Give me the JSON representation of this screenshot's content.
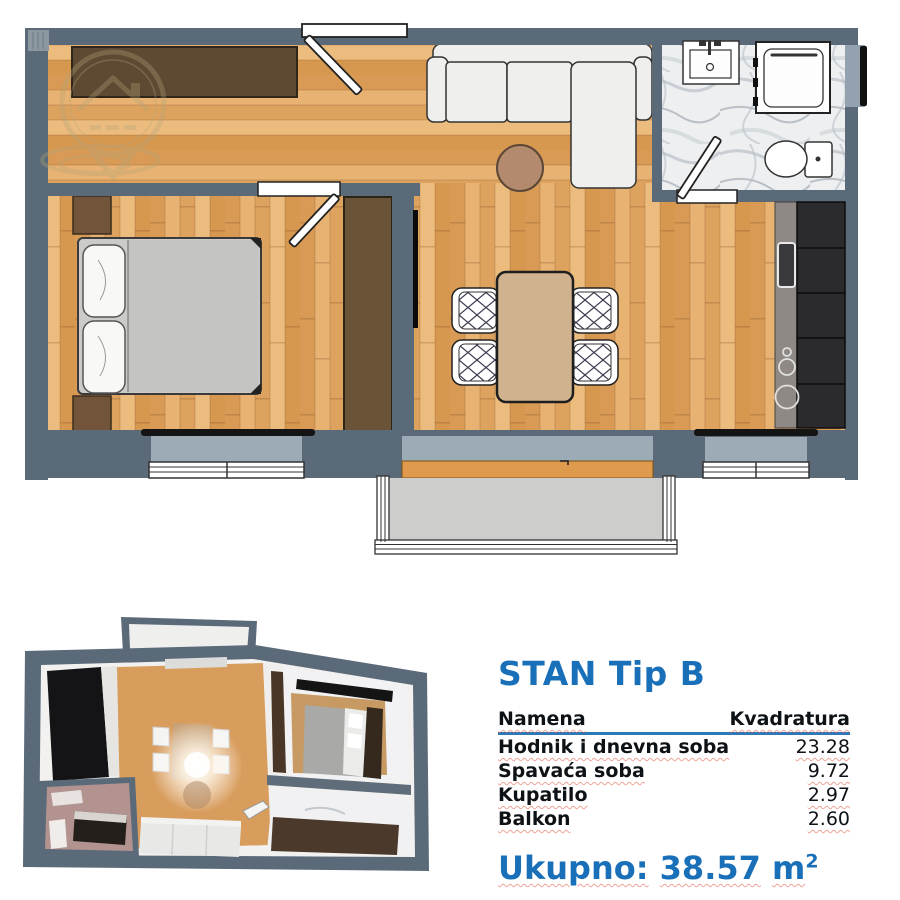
{
  "info": {
    "title": "STAN Tip B",
    "table": {
      "headers": [
        "Namena",
        "Kvadratura"
      ],
      "rows": [
        {
          "name": "Hodnik i dnevna soba",
          "value": "23.28"
        },
        {
          "name": "Spavaća soba",
          "value": "9.72"
        },
        {
          "name": "Kupatilo",
          "value": "2.97"
        },
        {
          "name": "Balkon",
          "value": "2.60"
        }
      ]
    },
    "total": {
      "label": "Ukupno:",
      "value": "38.57",
      "unit": "m",
      "unit_sup": "2"
    }
  },
  "colors": {
    "accent_blue": "#1a70b8",
    "wall_slate": "#5b6a79",
    "wood_floor": "#dfa567",
    "furniture_brown": "#6b5338",
    "threshold_orange": "#df9a4e",
    "window_recess": "#9dabb6",
    "marble": "#edeff1",
    "kitchen_dark": "#2b2b2d",
    "squiggle_red": "#e05a46"
  }
}
